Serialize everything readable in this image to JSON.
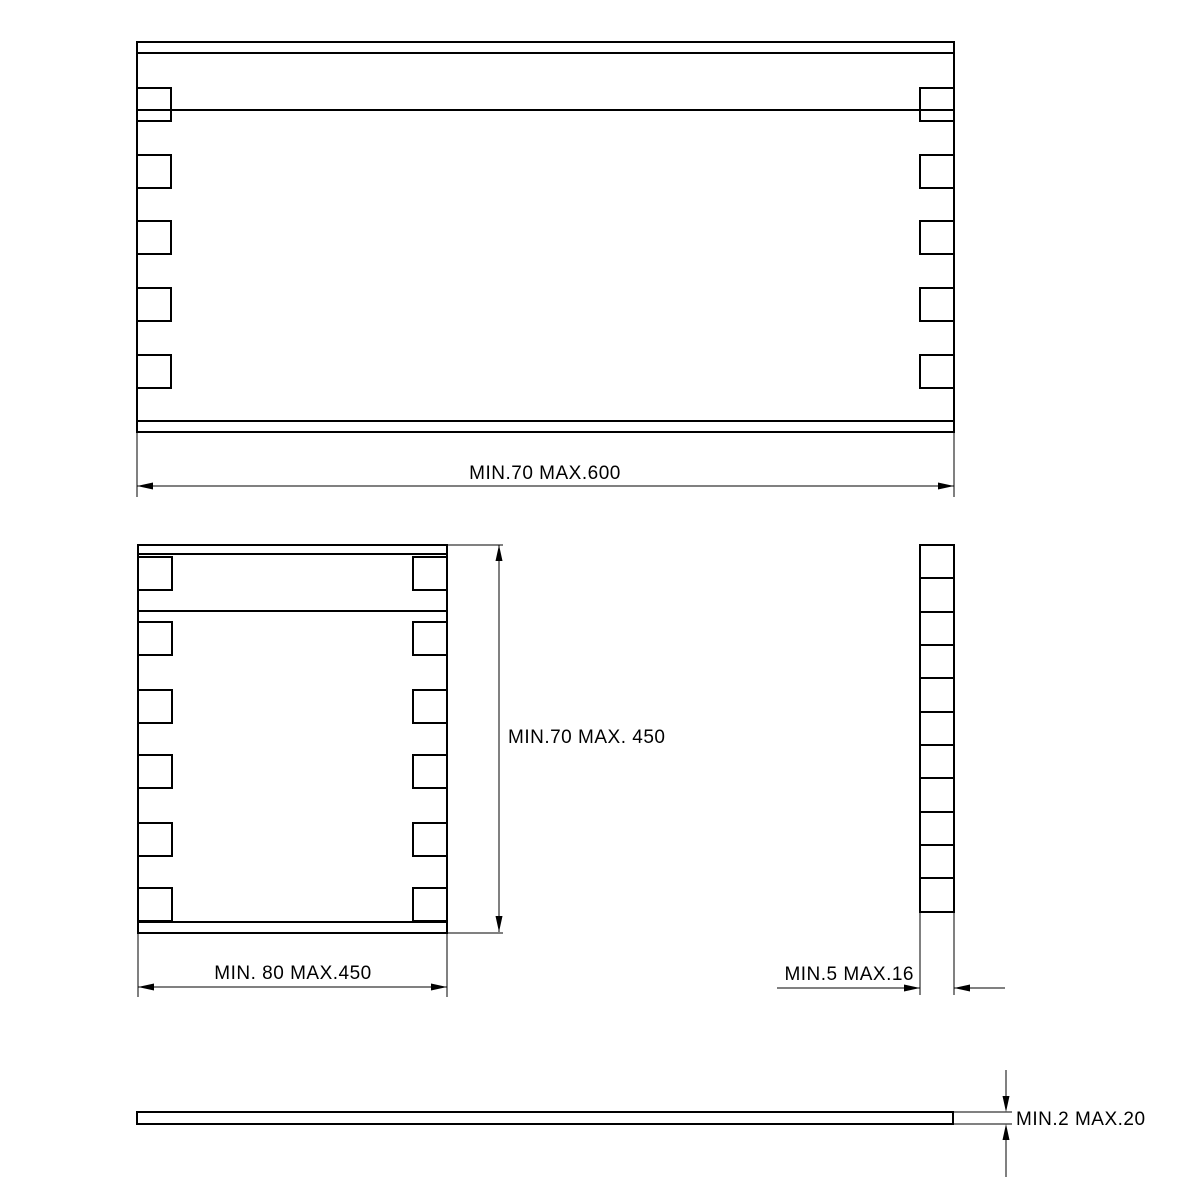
{
  "drawing": {
    "type": "technical-dimension-drawing",
    "background_color": "#ffffff",
    "line_color": "#000000",
    "labels": {
      "front_length": "MIN.70 MAX.600",
      "side_height": "MIN.70 MAX. 450",
      "end_width": "MIN. 80 MAX.450",
      "panel_thickness": "MIN.5 MAX.16",
      "lid_thickness": "MIN.2 MAX.20"
    }
  }
}
